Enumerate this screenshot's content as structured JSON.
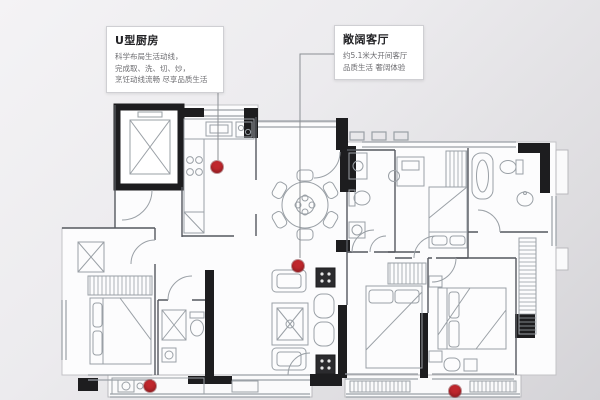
{
  "background": {
    "gradient_start": "#f4f3f5",
    "gradient_end": "#d4d3d7"
  },
  "plan_colors": {
    "wall": "#1d1d1f",
    "furniture_line": "#9aa0a6",
    "partition_line": "#55585e",
    "floor": "#fcfcfd"
  },
  "callouts": {
    "kitchen": {
      "title": "U型厨房",
      "lines": [
        "科学布局生活动线，",
        "完成取、洗、切、炒，",
        "烹饪动线流畅 尽享品质生活"
      ]
    },
    "living": {
      "title": "敞阔客厅",
      "lines": [
        "约5.1米大开间客厅",
        "品质生活 奢阔体验"
      ]
    }
  },
  "markers": {
    "color": "#c0272d",
    "points": [
      {
        "name": "kitchen",
        "x": 217,
        "y": 167
      },
      {
        "name": "living-room",
        "x": 298,
        "y": 266
      },
      {
        "name": "left-balcony",
        "x": 150,
        "y": 386
      },
      {
        "name": "right-balcony",
        "x": 455,
        "y": 391
      }
    ]
  }
}
